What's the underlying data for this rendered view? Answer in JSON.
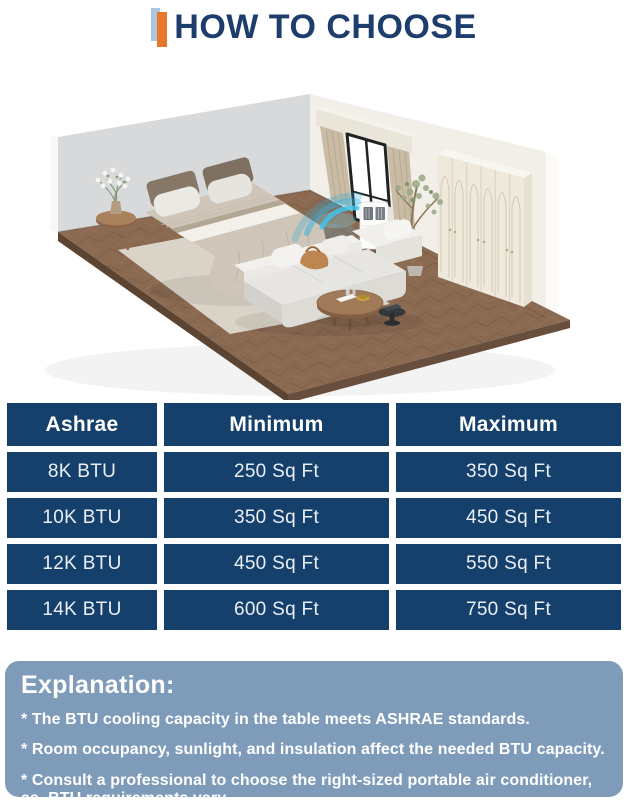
{
  "header": {
    "title": "HOW TO CHOOSE",
    "title_color": "#1d3e6d",
    "accent_blue": "#a9c7e3",
    "accent_orange": "#e8772c"
  },
  "scene": {
    "description": "isometric-bedroom-illustration",
    "objects": [
      "left-wall",
      "right-wall",
      "wood-herringbone-floor",
      "rug",
      "bed-with-pillows",
      "side-table-with-flowers",
      "window-with-curtains",
      "portable-air-conditioner",
      "cool-airflow",
      "tall-plant",
      "wardrobe-with-arched-doors",
      "modular-sofa",
      "round-coffee-table",
      "black-side-table"
    ],
    "colors": {
      "left_wall": "#d7d9db",
      "right_wall": "#f2efe9",
      "floor": "#8b6a52",
      "rug": "#dad3c7",
      "curtain": "#c9bba4",
      "airflow_blue": "#41c3ec"
    }
  },
  "table": {
    "cell_bg": "#15406b",
    "text_color": "#e9eff5",
    "columns": [
      "Ashrae",
      "Minimum",
      "Maximum"
    ],
    "rows": [
      [
        "8K BTU",
        "250 Sq Ft",
        "350 Sq Ft"
      ],
      [
        "10K BTU",
        "350 Sq Ft",
        "450 Sq Ft"
      ],
      [
        "12K BTU",
        "450 Sq Ft",
        "550 Sq Ft"
      ],
      [
        "14K BTU",
        "600 Sq Ft",
        "750 Sq Ft"
      ]
    ]
  },
  "explanation": {
    "bg": "#7e9cba",
    "title": "Explanation:",
    "bullets": [
      "* The BTU cooling capacity in the table meets ASHRAE standards.",
      "* Room occupancy, sunlight, and insulation affect the needed BTU capacity.",
      "* Consult a professional to choose the right-sized portable air conditioner, as  BTU requirements vary."
    ]
  }
}
